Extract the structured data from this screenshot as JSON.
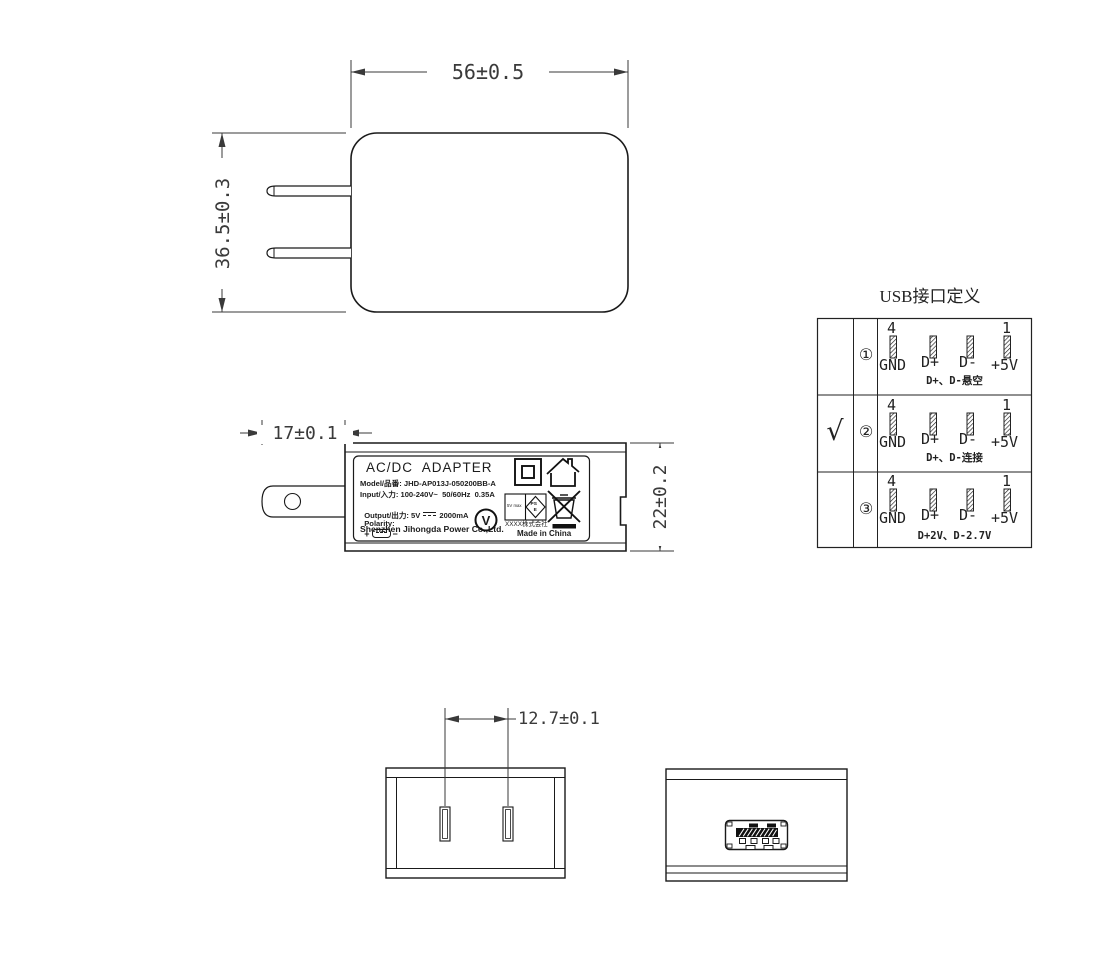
{
  "dimensions": {
    "front_width": "56±0.5",
    "front_height": "36.5±0.3",
    "prong_length": "17±0.1",
    "side_height": "22±0.2",
    "prong_spacing": "12.7±0.1"
  },
  "label": {
    "title": "AC/DC  ADAPTER",
    "model": "Model/品番: JHD-AP013J-050200BB-A",
    "input": "Input/入力: 100-240V~  50/60Hz  0.35A",
    "output_prefix": "Output/出力: 5V",
    "output_suffix": "2000mA",
    "polarity_label": "Polarity:",
    "polarity_plus": "+",
    "polarity_minus": "−",
    "manufacturer": "Shenzhen Jihongda Power Co.,Ltd.",
    "efficiency_mark": "V",
    "rating_box_text": "5V max",
    "pse_top": "PS",
    "pse_bottom": "E",
    "company_cjk": "XXXX株式会社",
    "made_in": "Made in China"
  },
  "usb_table": {
    "title": "USB接口定义",
    "pin_numbers": {
      "left": "4",
      "right": "1"
    },
    "pin_labels": [
      "GND",
      "D+",
      "D-",
      "+5V"
    ],
    "rows": [
      {
        "selected": "",
        "num": "①",
        "caption": "D+、D-悬空"
      },
      {
        "selected": "√",
        "num": "②",
        "caption": "D+、D-连接"
      },
      {
        "selected": "",
        "num": "③",
        "caption": "D+2V、D-2.7V"
      }
    ]
  }
}
